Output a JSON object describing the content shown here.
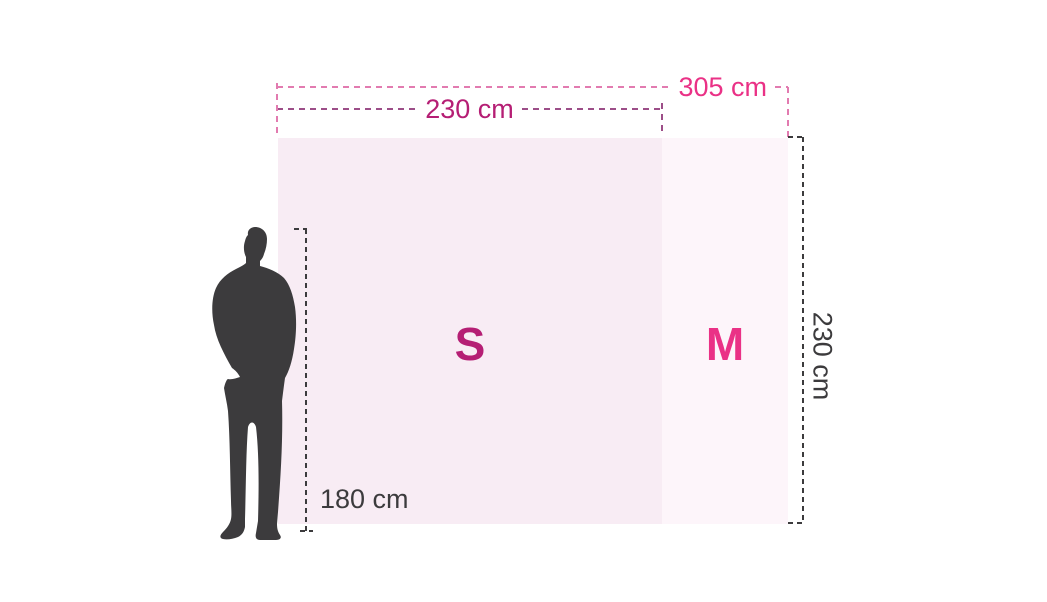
{
  "diagram": {
    "type": "display-size-comparison",
    "sizes": {
      "s": {
        "label": "S",
        "width_label": "230 cm"
      },
      "m": {
        "label": "M",
        "width_label": "305 cm"
      },
      "height_label": "230 cm"
    },
    "person": {
      "height_label": "180 cm",
      "icon": "person-silhouette"
    }
  },
  "colors": {
    "background": "#ffffff",
    "accent_pink": "#ea3186",
    "accent_magenta": "#b51e74",
    "pink_dash_line": "#e27bb0",
    "magenta_dash_line": "#9c4e88",
    "dark_gray": "#3c3b3d",
    "size_s_fill": "#f8ecf4",
    "size_m_fill": "#fdf5fa"
  }
}
